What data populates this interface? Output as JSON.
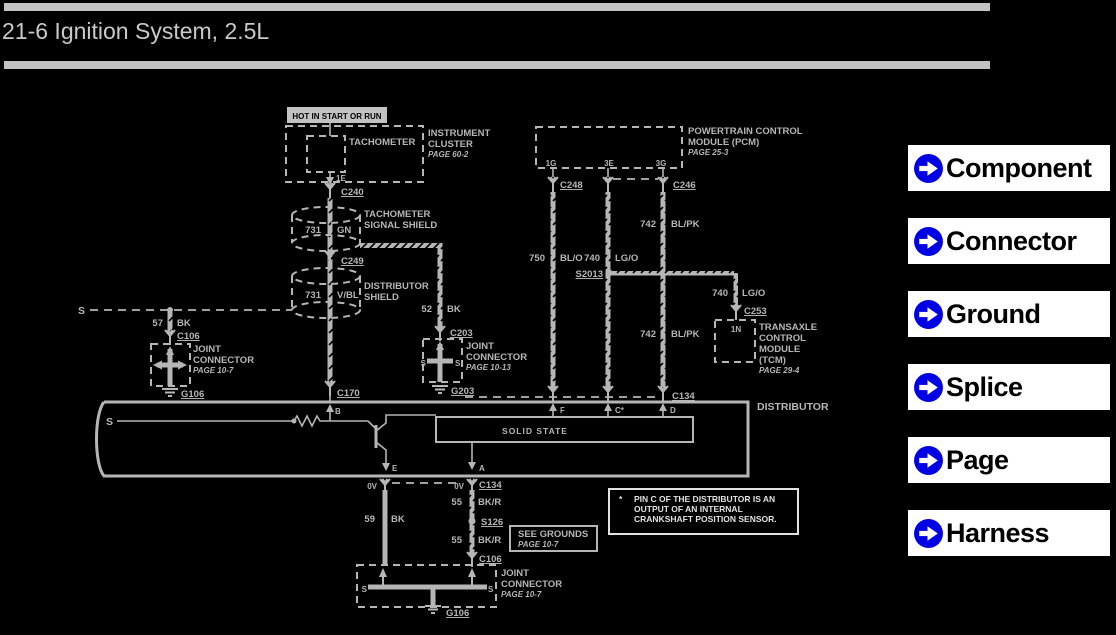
{
  "header": {
    "title": "21-6 Ignition System, 2.5L"
  },
  "sidebar": {
    "icon_color": "#0000e4",
    "buttons": [
      {
        "label": "Component"
      },
      {
        "label": "Connector"
      },
      {
        "label": "Ground"
      },
      {
        "label": "Splice"
      },
      {
        "label": "Page"
      },
      {
        "label": "Harness"
      }
    ]
  },
  "diagram": {
    "colors": {
      "line_gray": "#b6b6b6",
      "note_white": "#e2e2e2",
      "background": "#000000"
    },
    "sym_s": "S",
    "hot_label": "HOT IN START OR RUN",
    "cluster": {
      "component": "TACHOMETER",
      "name1": "INSTRUMENT",
      "name2": "CLUSTER",
      "page": "PAGE 60-2",
      "pin": "1E"
    },
    "c240": "C240",
    "shield1": {
      "num": "731",
      "color": "GN",
      "name1": "TACHOMETER",
      "name2": "SIGNAL SHIELD"
    },
    "c249": "C249",
    "shield2": {
      "num": "731",
      "color": "V/BL",
      "name1": "DISTRIBUTOR",
      "name2": "SHIELD"
    },
    "w52": {
      "num": "52",
      "color": "BK"
    },
    "c203": "C203",
    "joint2": {
      "name1": "JOINT",
      "name2": "CONNECTOR",
      "page": "PAGE 10-13"
    },
    "g203": "G203",
    "w57": {
      "num": "57",
      "color": "BK"
    },
    "c106": "C106",
    "joint1": {
      "name1": "JOINT",
      "name2": "CONNECTOR",
      "page": "PAGE 10-7"
    },
    "g106": "G106",
    "pcm": {
      "name1": "POWERTRAIN CONTROL",
      "name2": "MODULE (PCM)",
      "page": "PAGE 25-3",
      "pin1": "1G",
      "pin2": "3E",
      "pin3": "3G"
    },
    "c248": "C248",
    "c246": "C246",
    "w750": {
      "num": "750",
      "color": "BL/O"
    },
    "w740": {
      "num": "740",
      "color": "LG/O"
    },
    "s2013": "S2013",
    "w742a": {
      "num": "742",
      "color": "BL/PK"
    },
    "w742b": {
      "num": "742",
      "color": "BL/PK"
    },
    "w740b": {
      "num": "740",
      "color": "LG/O"
    },
    "c253": "C253",
    "tcm": {
      "pin": "1N",
      "name1": "TRANSAXLE",
      "name2": "CONTROL",
      "name3": "MODULE",
      "name4": "(TCM)",
      "page": "PAGE 29-4"
    },
    "distributor": {
      "label": "DISTRIBUTOR",
      "solid_state": "SOLID STATE",
      "pin_b": "B",
      "pin_f": "F",
      "pin_c": "C*",
      "pin_d": "D",
      "pin_e": "E",
      "pin_a": "A"
    },
    "c134_top": "C134",
    "c170": "C170",
    "volts_e": "0V",
    "volts_a": "0V",
    "c134_bot": "C134",
    "w59": {
      "num": "59",
      "color": "BK"
    },
    "w55a": {
      "num": "55",
      "color": "BK/R"
    },
    "s126": "S126",
    "w55b": {
      "num": "55",
      "color": "BK/R"
    },
    "c106_bot": "C106",
    "see_grounds": {
      "title": "SEE GROUNDS",
      "page": "PAGE 10-7"
    },
    "joint3": {
      "name1": "JOINT",
      "name2": "CONNECTOR",
      "page": "PAGE 10-7"
    },
    "g106_bot": "G106",
    "note": {
      "star": "*",
      "line1": "PIN C OF THE DISTRIBUTOR IS AN",
      "line2": "OUTPUT OF AN INTERNAL",
      "line3": "CRANKSHAFT POSITION SENSOR."
    }
  }
}
